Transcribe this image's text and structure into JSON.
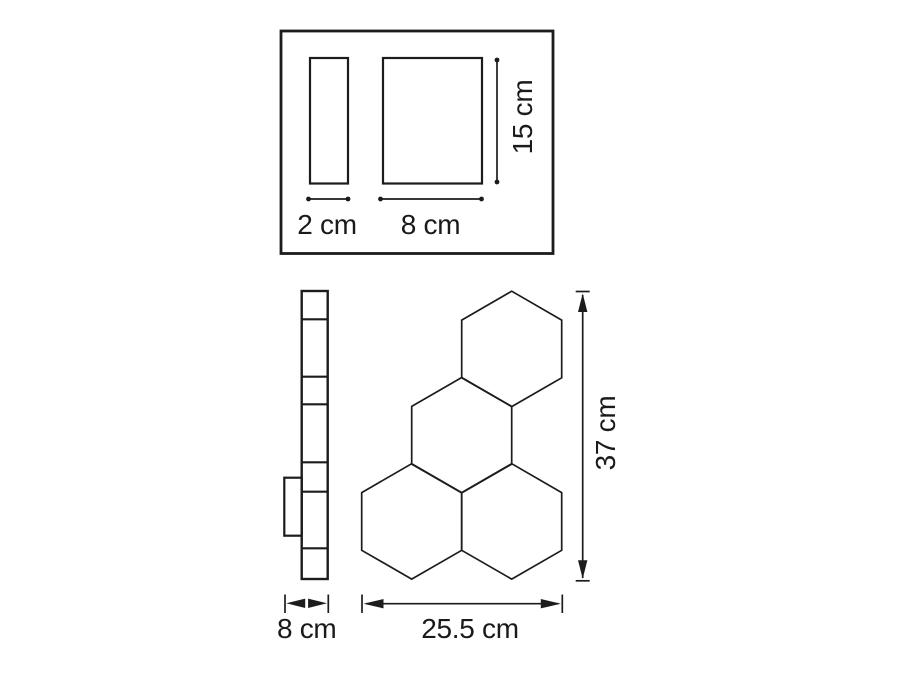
{
  "diagram": {
    "background_color": "#ffffff",
    "line_color": "#1c1c1c",
    "text_color": "#1a1a1a",
    "top_view": {
      "narrow_width_label": "2 cm",
      "wide_width_label": "8 cm",
      "height_label": "15 cm"
    },
    "front_view": {
      "depth_label": "8 cm",
      "width_label": "25.5 cm",
      "height_label": "37 cm"
    }
  }
}
